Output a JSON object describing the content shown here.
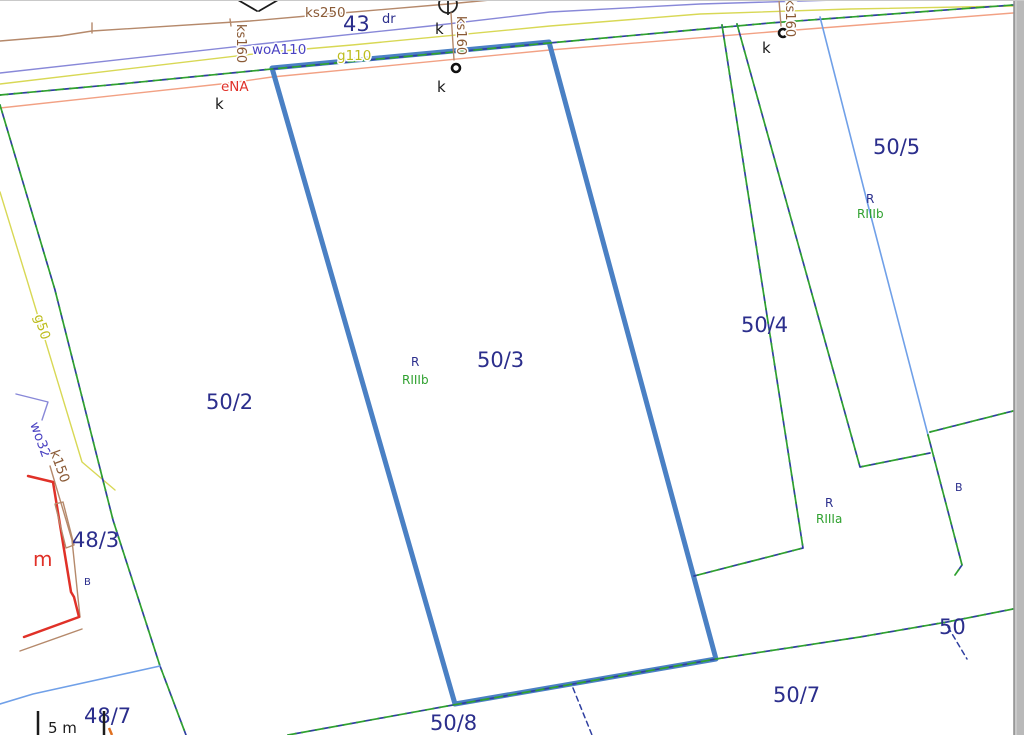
{
  "labels": {
    "parcel_43": "43",
    "parcel_50_2": "50/2",
    "parcel_50_3": "50/3",
    "parcel_50_4": "50/4",
    "parcel_50_5": "50/5",
    "parcel_50_7": "50/7",
    "parcel_50_8": "50/8",
    "parcel_50": "50",
    "parcel_48_3": "48/3",
    "parcel_48_7": "48/7",
    "road_marker": "dr",
    "ks250": "ks250",
    "ks160": "ks160",
    "woA110": "woA110",
    "g110": "g110",
    "eNA": "eNA",
    "g50": "g50",
    "wo32": "wo32",
    "k150": "k150",
    "class_r": "R",
    "class_riiib": "RIIIb",
    "class_riiia": "RIIIa",
    "class_b": "B",
    "building_m": "m",
    "point_k": "k",
    "scale_text": "5 m"
  },
  "colors": {
    "parcel_highlight": "#4a80c4",
    "parcel_label_navy": "#2b2e8c",
    "boundary_navy": "#2f3fa0",
    "class_green": "#2fa12f",
    "sewer_line_brown": "#b5896b",
    "sewer_label_brown": "#8a5a36",
    "water_line_purple": "#8888d8",
    "water_label_purple": "#4a42c2",
    "gas_line_yellow": "#d8d855",
    "gas_label_yellow": "#bdbd1e",
    "power_line_salmon": "#f2a184",
    "power_red": "#e03128",
    "water_blue": "#70a0e8",
    "black": "#1b1b1b",
    "scale_orange": "#e07020",
    "border_gray": "#b9b9b9",
    "border_edge_gray": "#8e8e8e",
    "border_top_gray": "#c9c9c9"
  }
}
